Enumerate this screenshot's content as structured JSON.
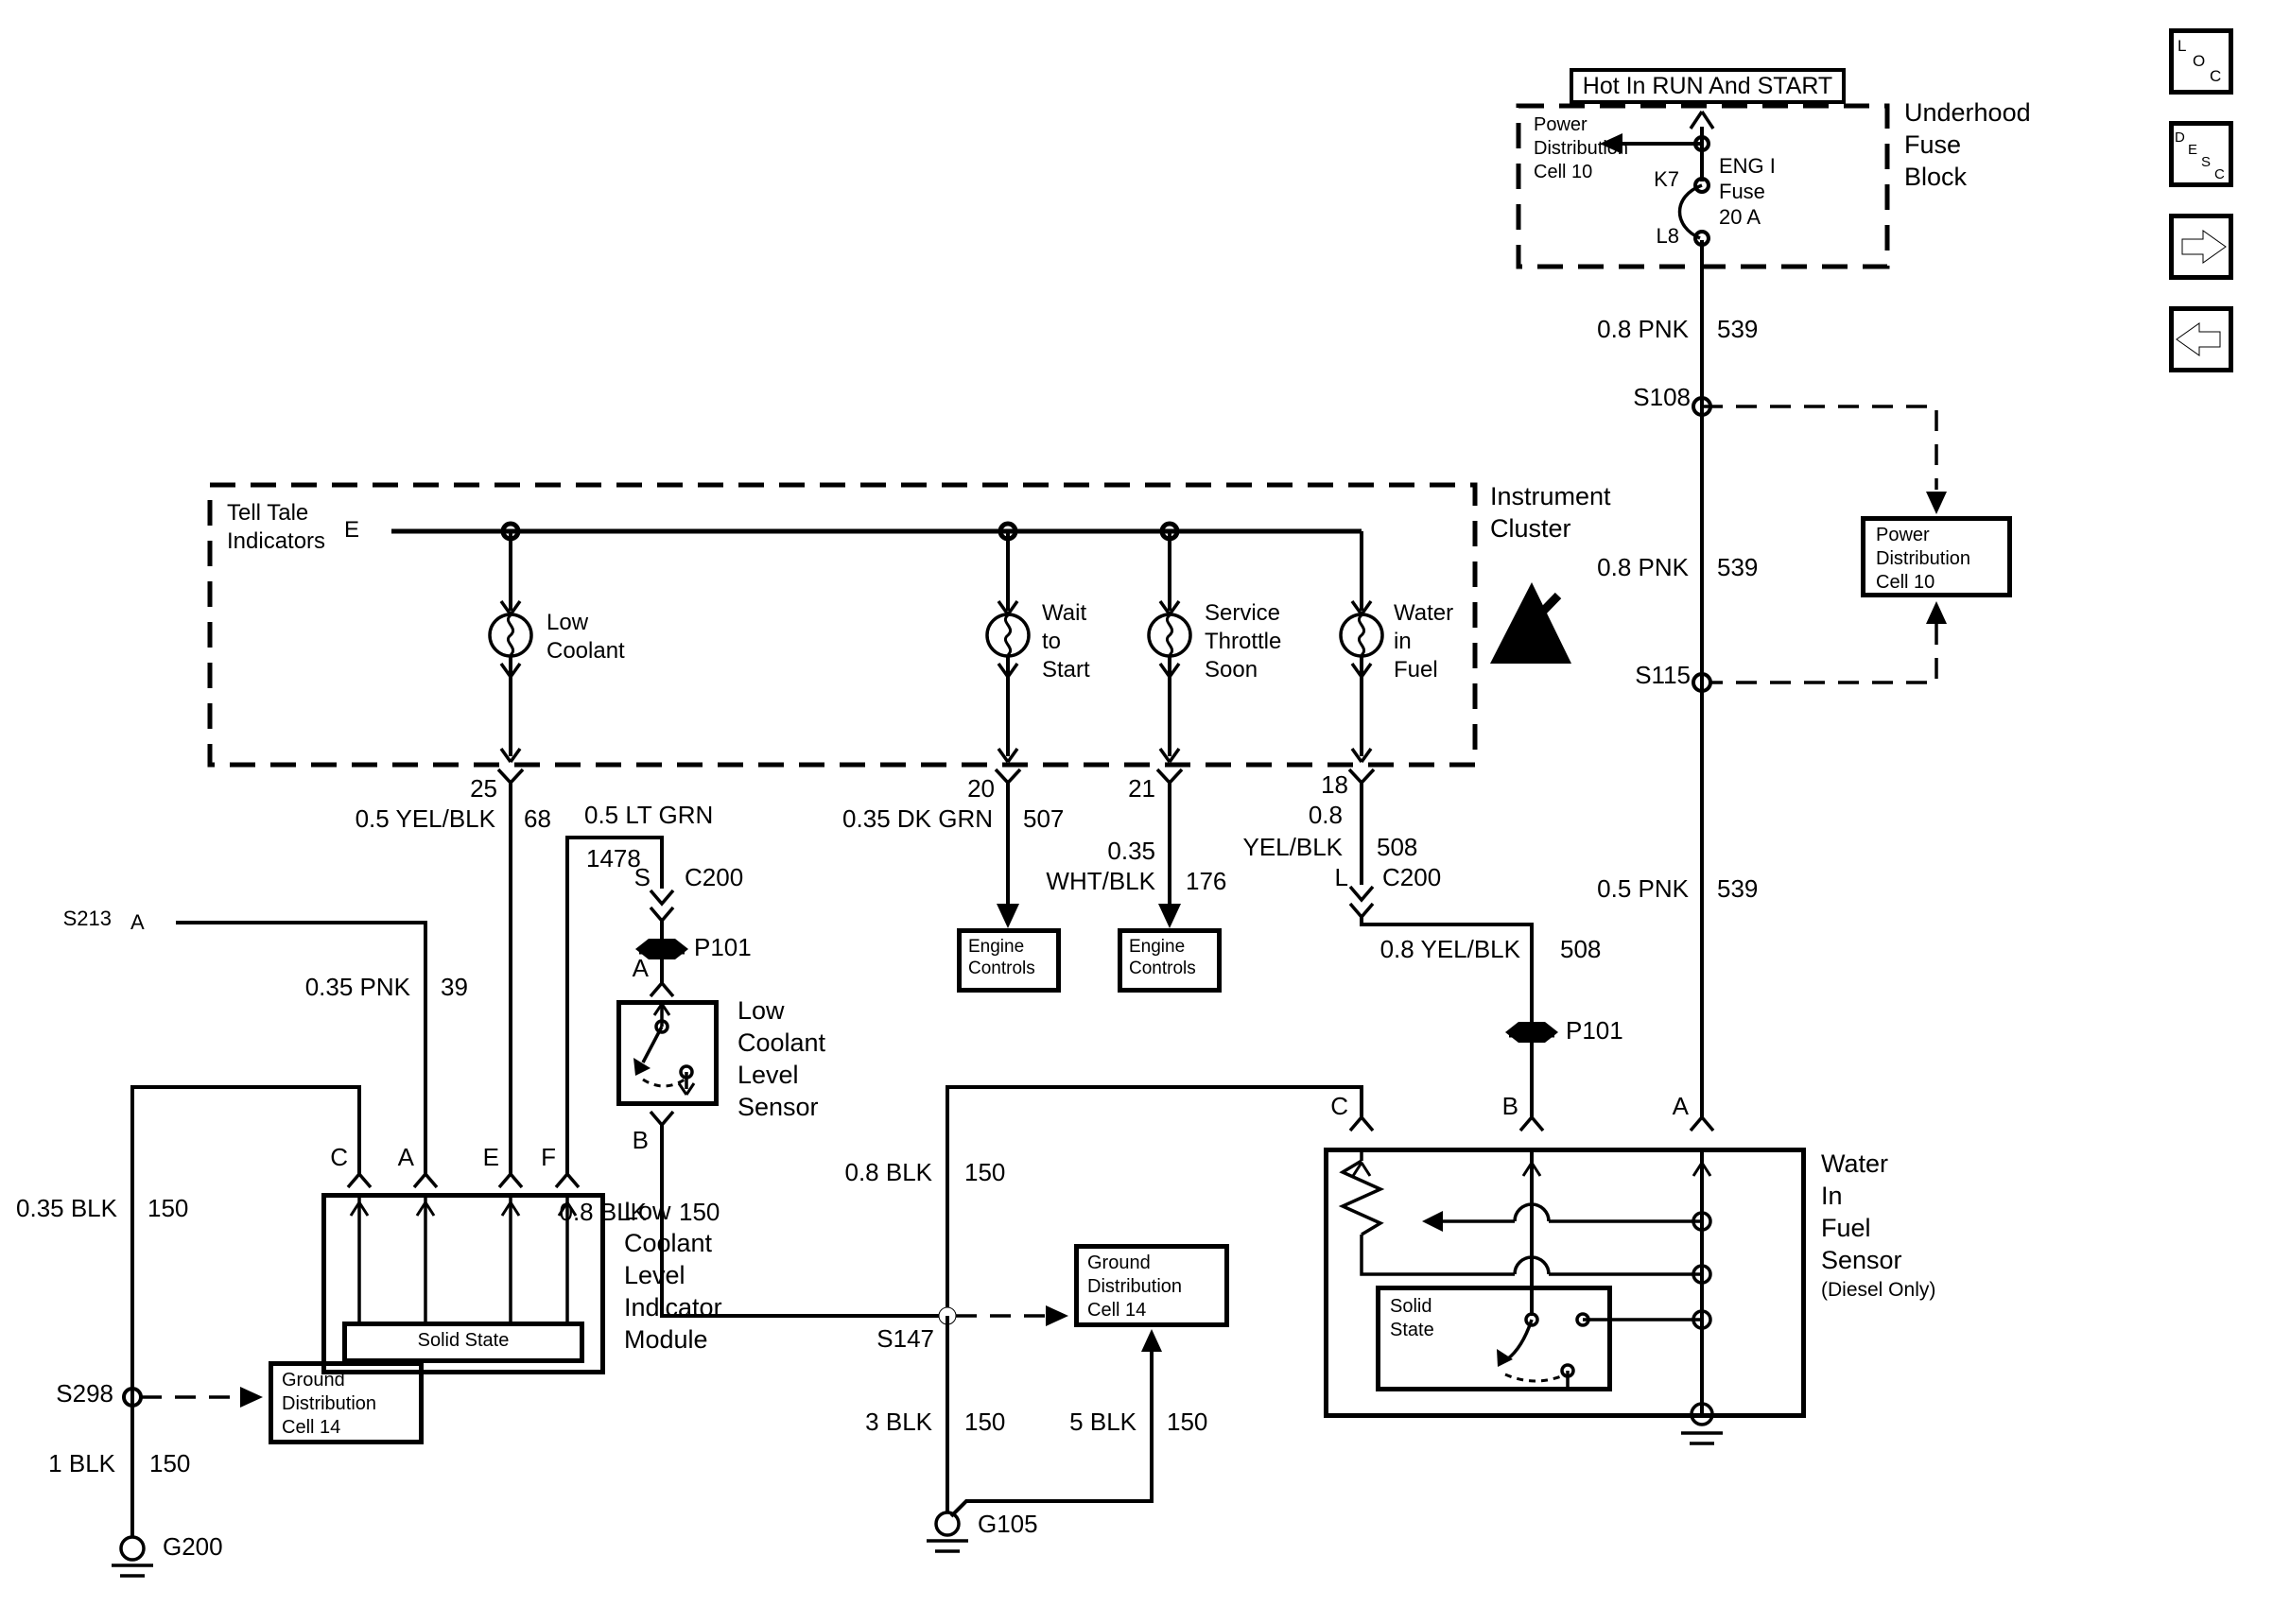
{
  "banner": {
    "text": "Hot In RUN And START"
  },
  "fuse_block": {
    "pdc": [
      "Power",
      "Distribution",
      "Cell 10"
    ],
    "k7": "K7",
    "l8": "L8",
    "fuse": [
      "ENG I",
      "Fuse",
      "20 A"
    ],
    "name": [
      "Underhood",
      "Fuse",
      "Block"
    ]
  },
  "power": {
    "w539a": {
      "color": "0.8 PNK",
      "circuit": "539"
    },
    "s108": "S108",
    "w539b": {
      "color": "0.8 PNK",
      "circuit": "539"
    },
    "s115": "S115",
    "w539c": {
      "color": "0.5 PNK",
      "circuit": "539"
    },
    "pdc_box": [
      "Power",
      "Distribution",
      "Cell 10"
    ]
  },
  "cluster": {
    "name": [
      "Instrument",
      "Cluster"
    ],
    "telltale": [
      "Tell Tale",
      "Indicators"
    ],
    "gate": "E",
    "lamp1": [
      "Low",
      "Coolant"
    ],
    "lamp2": [
      "Wait",
      "to",
      "Start"
    ],
    "lamp3": [
      "Service",
      "Throttle",
      "Soon"
    ],
    "lamp4": [
      "Water",
      "in",
      "Fuel"
    ],
    "pin25": "25",
    "pin20": "20",
    "pin21": "21",
    "pin18": "18"
  },
  "wires": {
    "w68": {
      "color": "0.5 YEL/BLK",
      "circuit": "68"
    },
    "w1478": {
      "color": "0.5 LT GRN",
      "circuit": "1478"
    },
    "w507": {
      "color": "0.35 DK GRN",
      "circuit": "507"
    },
    "w176": {
      "color1": "0.35",
      "color2": "WHT/BLK",
      "circuit": "176"
    },
    "w508a": {
      "color1": "0.8",
      "color2": "YEL/BLK",
      "circuit": "508"
    },
    "w508b": {
      "color": "0.8 YEL/BLK",
      "circuit": "508"
    },
    "w39": {
      "color": "0.35 PNK",
      "circuit": "39"
    },
    "w150a": {
      "color": "0.35 BLK",
      "circuit": "150"
    },
    "w150b": {
      "color": "0.8 BLK",
      "circuit": "150"
    },
    "w150c": {
      "color": "0.8 BLK",
      "circuit": "150"
    },
    "w150d": {
      "color": "1 BLK",
      "circuit": "150"
    },
    "w150e": {
      "color": "3 BLK",
      "circuit": "150"
    },
    "w150f": {
      "color": "5 BLK",
      "circuit": "150"
    }
  },
  "connectors": {
    "c200s": {
      "pin": "S",
      "name": "C200"
    },
    "c200l": {
      "pin": "L",
      "name": "C200"
    },
    "p101a": "P101",
    "p101b": "P101"
  },
  "splices": {
    "s213": "S213",
    "s298": "S298",
    "s147": "S147"
  },
  "gates": {
    "s213_pin": "A"
  },
  "grounds": {
    "g200": "G200",
    "g105": "G105"
  },
  "engine_controls_a": [
    "Engine",
    "Controls"
  ],
  "engine_controls_b": [
    "Engine",
    "Controls"
  ],
  "ground_distribution_a": [
    "Ground",
    "Distribution",
    "Cell 14"
  ],
  "ground_distribution_b": [
    "Ground",
    "Distribution",
    "Cell 14"
  ],
  "module": {
    "pin_c": "C",
    "pin_a": "A",
    "pin_e": "E",
    "pin_f": "F",
    "solid_state": "Solid State",
    "name": [
      "Low",
      "Coolant",
      "Level",
      "Indicator",
      "Module"
    ]
  },
  "lcl_sensor": {
    "pin_a": "A",
    "pin_b": "B",
    "name": [
      "Low",
      "Coolant",
      "Level",
      "Sensor"
    ]
  },
  "wif_sensor": {
    "pin_c": "C",
    "pin_b": "B",
    "pin_a": "A",
    "solid_state": [
      "Solid",
      "State"
    ],
    "name": [
      "Water",
      "In",
      "Fuel",
      "Sensor"
    ],
    "sub": "(Diesel Only)"
  },
  "nav": {
    "loc": [
      "L",
      "O",
      "C"
    ],
    "desc": [
      "D",
      "E",
      "S",
      "C"
    ]
  }
}
